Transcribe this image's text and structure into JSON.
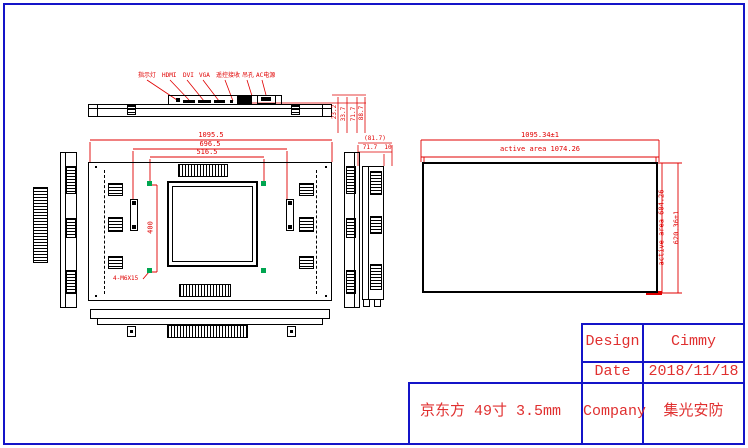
{
  "colors": {
    "page_border": "#1414c8",
    "geometry": "#000000",
    "dimension_red": "#e00000",
    "marker_green": "#00a550",
    "table_text_red": "#e03030"
  },
  "top_view": {
    "port_labels": [
      "指示灯",
      "HDMI",
      "DVI",
      "VGA",
      "遥控接收",
      "吊孔",
      "AC电源"
    ],
    "depth_dims": [
      "23.2",
      "33.7",
      "71.7",
      "88.7"
    ]
  },
  "front_view": {
    "dim_overall_width": "1095.5",
    "dim_rail_spacing": "696.5",
    "dim_hole_spacing_h": "516.5",
    "dim_hole_spacing_v": "400",
    "hole_callout": "4-M6X15"
  },
  "side_view": {
    "dim_total_depth": "(81.7)",
    "dim_body_depth": "71.7",
    "dim_foot": "10"
  },
  "panel_view": {
    "dim_width": "1095.34±1",
    "dim_active_width": "active area 1074.26",
    "dim_active_height": "active area 604.26",
    "dim_height": "620.36±1"
  },
  "title_block": {
    "rows": [
      {
        "label": "Design",
        "value": "Cimmy"
      },
      {
        "label": "Date",
        "value": "2018/11/18"
      },
      {
        "label": "Company",
        "value": "集光安防"
      }
    ],
    "note": "京东方 49寸 3.5mm"
  }
}
